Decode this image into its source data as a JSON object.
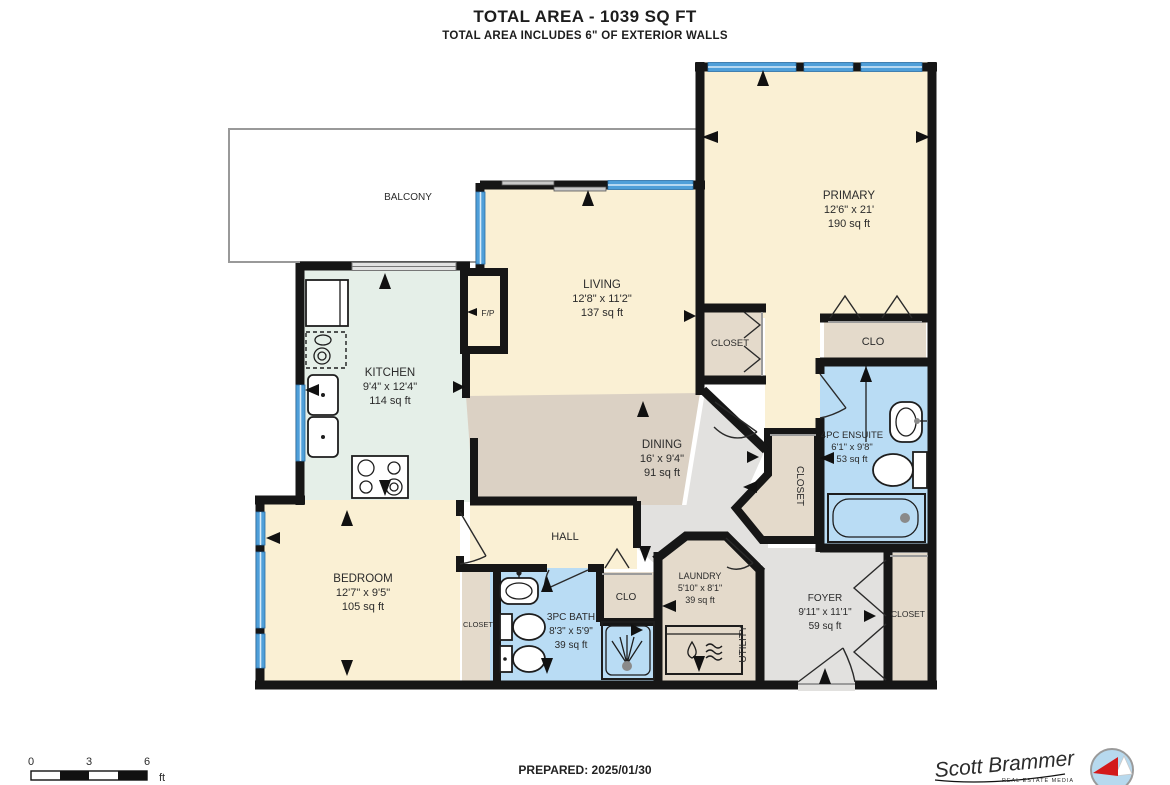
{
  "header": {
    "title": "TOTAL AREA - 1039 SQ FT",
    "subtitle": "TOTAL AREA INCLUDES 6\" OF EXTERIOR WALLS"
  },
  "rooms": {
    "balcony": {
      "name": "BALCONY"
    },
    "primary": {
      "name": "PRIMARY",
      "dims": "12'6\" x 21'",
      "area": "190 sq ft"
    },
    "living": {
      "name": "LIVING",
      "dims": "12'8\" x 11'2\"",
      "area": "137 sq ft"
    },
    "kitchen": {
      "name": "KITCHEN",
      "dims": "9'4\" x 12'4\"",
      "area": "114 sq ft"
    },
    "dining": {
      "name": "DINING",
      "dims": "16' x 9'4\"",
      "area": "91 sq ft"
    },
    "hall": {
      "name": "HALL"
    },
    "bedroom": {
      "name": "BEDROOM",
      "dims": "12'7\" x 9'5\"",
      "area": "105 sq ft"
    },
    "bath": {
      "name": "3PC BATH",
      "dims": "8'3\" x 5'9\"",
      "area": "39 sq ft"
    },
    "ensuite": {
      "name": "4PC ENSUITE",
      "dims": "6'1\" x 9'8\"",
      "area": "53 sq ft"
    },
    "laundry": {
      "name": "LAUNDRY",
      "dims": "5'10\" x 8'1\"",
      "area": "39 sq ft"
    },
    "foyer": {
      "name": "FOYER",
      "dims": "9'11\" x 11'1\"",
      "area": "59 sq ft"
    },
    "utility": {
      "name": "UTILITY"
    }
  },
  "closets": {
    "primary_reach_in": "CLOSET",
    "primary_clo": "CLO",
    "walk_in": "CLOSET",
    "bedroom": "CLOSET",
    "hall_clo": "CLO",
    "foyer": "CLOSET"
  },
  "features": {
    "fireplace": "F/P"
  },
  "scale_bar": {
    "ticks": [
      "0",
      "3",
      "6"
    ],
    "unit": "ft"
  },
  "footer": {
    "prepared": "PREPARED: 2025/01/30",
    "brand": "Scott Brammer",
    "brand_tagline": "REAL ESTATE MEDIA"
  },
  "colors": {
    "room_cream": "#faf0d4",
    "kitchen_mint": "#e5efe8",
    "dining_tan": "#dbd1c4",
    "closet_tan": "#e4dacb",
    "bath_blue": "#b9dcf4",
    "foyer_gray": "#e2e1df",
    "window_blue": "#4f9fd9",
    "wall": "#161616"
  }
}
